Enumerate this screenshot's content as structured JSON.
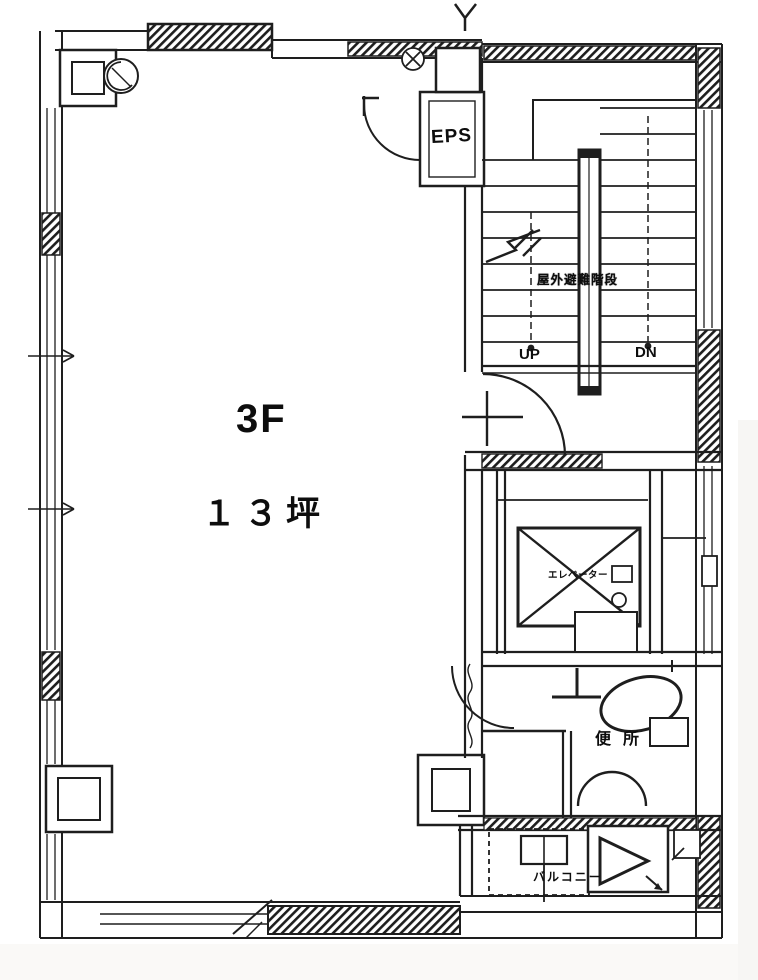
{
  "title": "3F floor plan",
  "labels": {
    "floor": "3F",
    "area": "１３坪",
    "eps": "EPS",
    "stair_note": "屋外避難階段",
    "up": "UP",
    "down": "DN",
    "elevator": "エレベーター",
    "toilet": "便所",
    "balcony": "バルコニー"
  },
  "colors": {
    "line": "#1e1e1e",
    "paper": "#ffffff"
  }
}
